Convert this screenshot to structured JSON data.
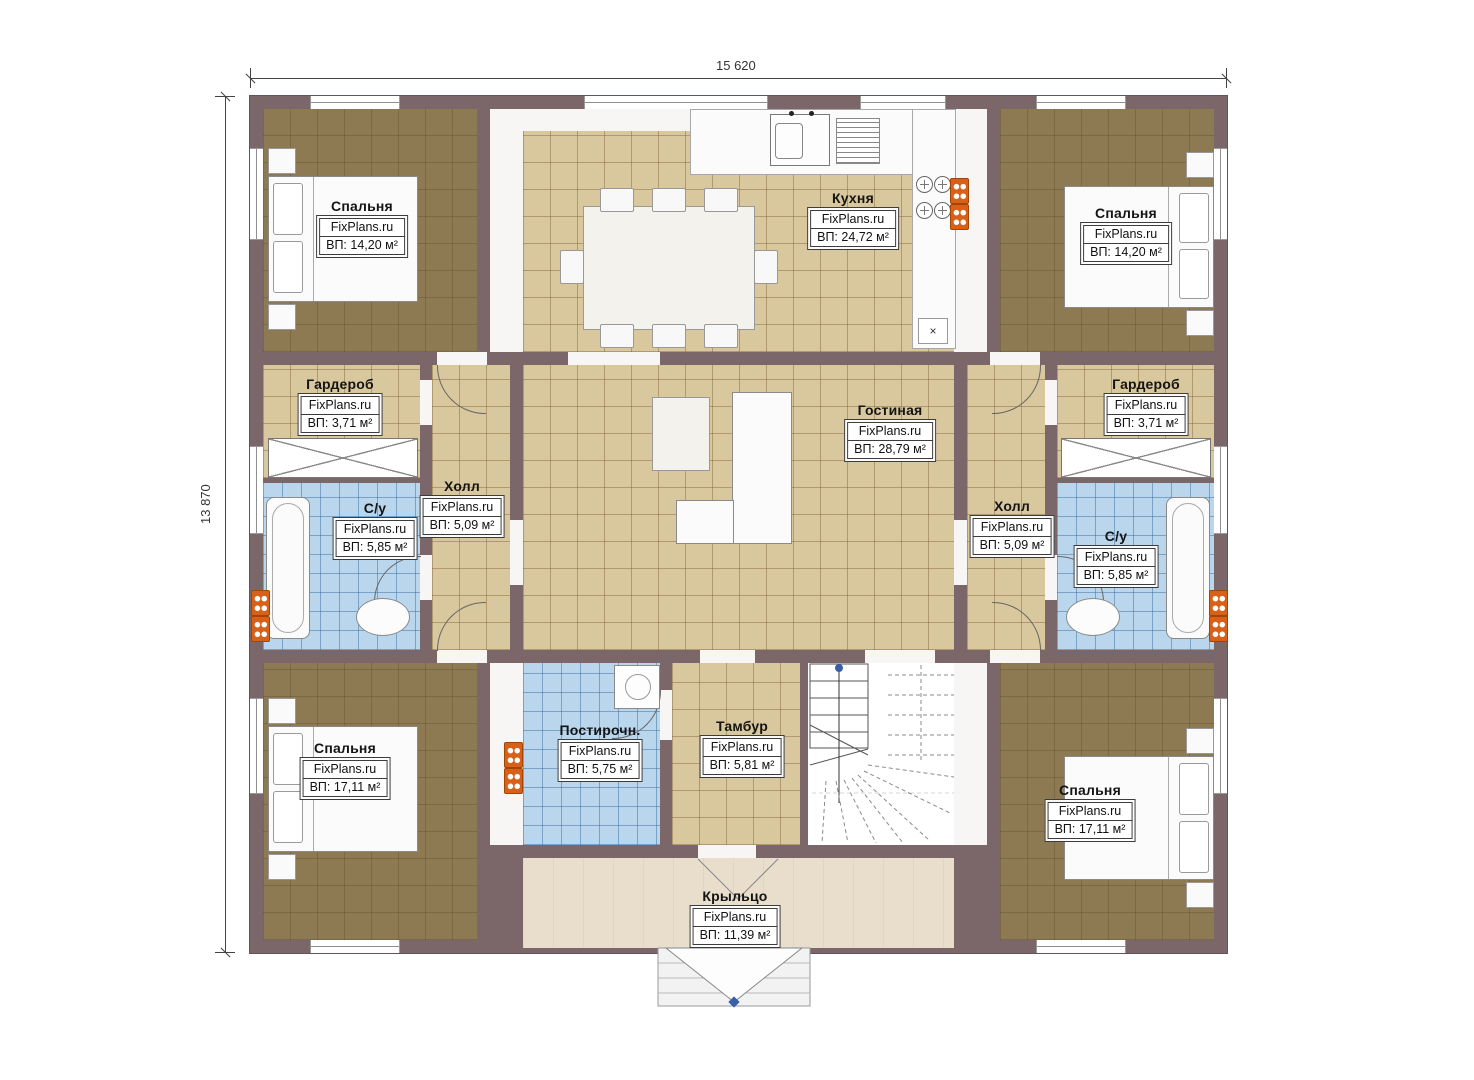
{
  "dimensions": {
    "width": "15 620",
    "height": "13 870"
  },
  "brand": "FixPlans.ru",
  "rooms": {
    "bedroom_top_left": {
      "name": "Спальня",
      "area": "ВП: 14,20 м²"
    },
    "kitchen": {
      "name": "Кухня",
      "area": "ВП: 24,72 м²"
    },
    "bedroom_top_right": {
      "name": "Спальня",
      "area": "ВП: 14,20 м²"
    },
    "wardrobe_left": {
      "name": "Гардероб",
      "area": "ВП: 3,71 м²"
    },
    "bathroom_left": {
      "name": "С/у",
      "area": "ВП: 5,85 м²"
    },
    "hall_left": {
      "name": "Холл",
      "area": "ВП: 5,09 м²"
    },
    "living_room": {
      "name": "Гостиная",
      "area": "ВП: 28,79 м²"
    },
    "hall_right": {
      "name": "Холл",
      "area": "ВП: 5,09 м²"
    },
    "wardrobe_right": {
      "name": "Гардероб",
      "area": "ВП: 3,71 м²"
    },
    "bathroom_right": {
      "name": "С/у",
      "area": "ВП: 5,85 м²"
    },
    "bedroom_bottom_left": {
      "name": "Спальня",
      "area": "ВП: 17,11 м²"
    },
    "laundry": {
      "name": "Постирочн.",
      "area": "ВП: 5,75 м²"
    },
    "vestibule": {
      "name": "Тамбур",
      "area": "ВП: 5,81 м²"
    },
    "bedroom_bottom_right": {
      "name": "Спальня",
      "area": "ВП: 17,11 м²"
    },
    "porch": {
      "name": "Крыльцо",
      "area": "ВП: 11,39 м²"
    }
  },
  "markers": {
    "close": "×"
  },
  "colors": {
    "wall": "#7b676a",
    "floor_wood": "#8d7a52",
    "floor_tile": "#d9c79e",
    "floor_wet": "#b9d6ec",
    "porch": "#e8decb",
    "radiator": "#d96018",
    "accent": "#3a5fa8"
  }
}
